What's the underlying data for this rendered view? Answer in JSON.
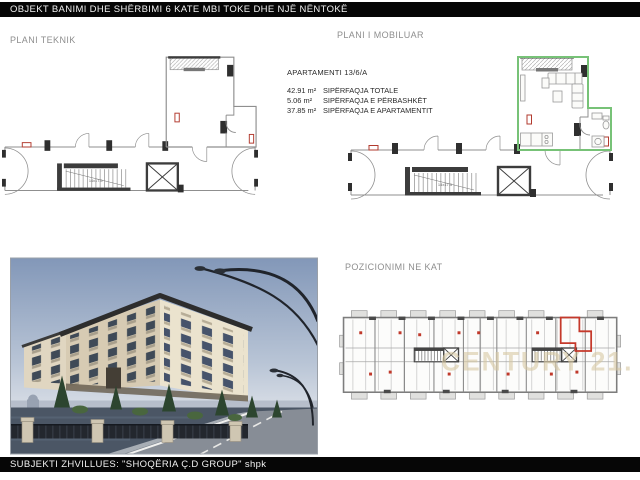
{
  "header": {
    "title": "OBJEKT BANIMI DHE SHËRBIMI 6 KATE MBI TOKE DHE NJË NËNTOKË"
  },
  "footer": {
    "title": "SUBJEKTI ZHVILLUES: \"SHOQËRIA Ç.D GROUP\" shpk"
  },
  "labels": {
    "technical_plan": "PLANI TEKNIK",
    "furnished_plan": "PLANI I MOBILUAR",
    "floor_position": "POZICIONIMI NE KAT"
  },
  "apartment": {
    "title": "APARTAMENTI 13/6/A",
    "areas": [
      {
        "value": "42.91 m²",
        "label": "SIPËRFAQJA TOTALE"
      },
      {
        "value": "5.06 m²",
        "label": "SIPËRFAQJA E PËRBASHKËT"
      },
      {
        "value": "37.85 m²",
        "label": "SIPËRFAQJA E APARTAMENTIT"
      }
    ]
  },
  "plans": {
    "stair_label": "14x17.5"
  },
  "key_plan": {
    "watermark": "CENTURY 21."
  },
  "colors": {
    "highlight_green": "#77c277",
    "highlight_red": "#c0392b",
    "watermark_tan": "#d8c9a3",
    "bar_black": "#060606"
  }
}
